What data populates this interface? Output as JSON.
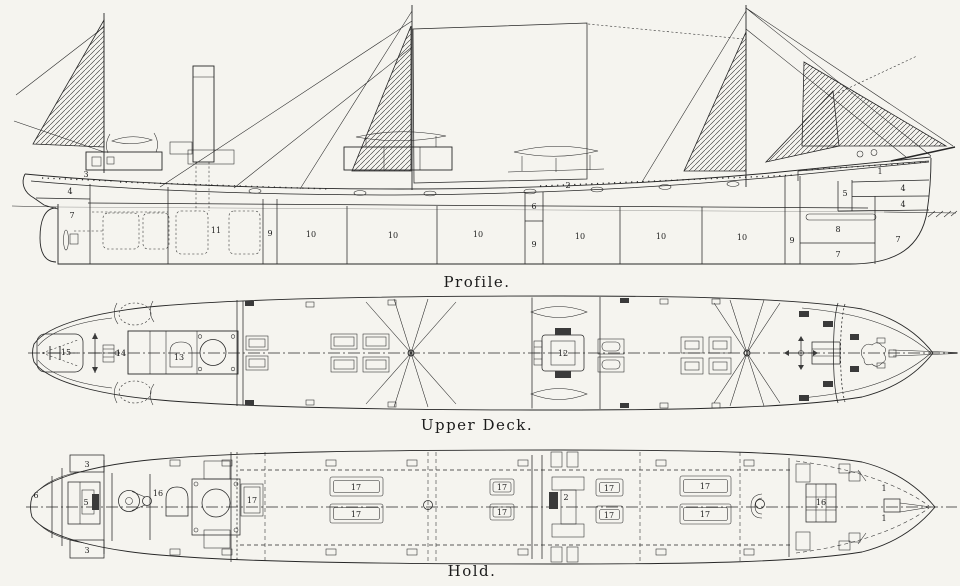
{
  "page": {
    "background": "#f5f4ef",
    "ink": "#272727"
  },
  "views": {
    "profile": {
      "caption": "Profile.",
      "labels": [
        {
          "t": "3",
          "x": 86,
          "y": 177
        },
        {
          "t": "4",
          "x": 70,
          "y": 194
        },
        {
          "t": "7",
          "x": 72,
          "y": 218
        },
        {
          "t": "11",
          "x": 216,
          "y": 233
        },
        {
          "t": "9",
          "x": 270,
          "y": 236
        },
        {
          "t": "10",
          "x": 311,
          "y": 237
        },
        {
          "t": "10",
          "x": 393,
          "y": 238
        },
        {
          "t": "10",
          "x": 478,
          "y": 237
        },
        {
          "t": "2",
          "x": 568,
          "y": 188
        },
        {
          "t": "6",
          "x": 534,
          "y": 209
        },
        {
          "t": "9",
          "x": 534,
          "y": 247
        },
        {
          "t": "10",
          "x": 580,
          "y": 239
        },
        {
          "t": "10",
          "x": 661,
          "y": 239
        },
        {
          "t": "10",
          "x": 742,
          "y": 240
        },
        {
          "t": "9",
          "x": 792,
          "y": 243
        },
        {
          "t": "8",
          "x": 838,
          "y": 232
        },
        {
          "t": "7",
          "x": 838,
          "y": 257
        },
        {
          "t": "1",
          "x": 880,
          "y": 174
        },
        {
          "t": "5",
          "x": 845,
          "y": 196
        },
        {
          "t": "4",
          "x": 903,
          "y": 191
        },
        {
          "t": "4",
          "x": 903,
          "y": 207
        },
        {
          "t": "7",
          "x": 898,
          "y": 242
        }
      ]
    },
    "upper_deck": {
      "caption": "Upper Deck.",
      "labels": [
        {
          "t": "15",
          "x": 66,
          "y": 355
        },
        {
          "t": "14",
          "x": 121,
          "y": 356
        },
        {
          "t": "13",
          "x": 179,
          "y": 360
        },
        {
          "t": "12",
          "x": 563,
          "y": 356
        }
      ]
    },
    "hold": {
      "caption": "Hold.",
      "labels": [
        {
          "t": "6",
          "x": 36,
          "y": 498
        },
        {
          "t": "3",
          "x": 87,
          "y": 467
        },
        {
          "t": "3",
          "x": 87,
          "y": 553
        },
        {
          "t": "5",
          "x": 86,
          "y": 505
        },
        {
          "t": "16",
          "x": 158,
          "y": 496
        },
        {
          "t": "17",
          "x": 252,
          "y": 503
        },
        {
          "t": "17",
          "x": 356,
          "y": 490
        },
        {
          "t": "17",
          "x": 356,
          "y": 517
        },
        {
          "t": "17",
          "x": 502,
          "y": 490
        },
        {
          "t": "17",
          "x": 502,
          "y": 515
        },
        {
          "t": "2",
          "x": 566,
          "y": 500
        },
        {
          "t": "17",
          "x": 609,
          "y": 491
        },
        {
          "t": "17",
          "x": 609,
          "y": 518
        },
        {
          "t": "17",
          "x": 705,
          "y": 489
        },
        {
          "t": "17",
          "x": 705,
          "y": 517
        },
        {
          "t": "16",
          "x": 821,
          "y": 505
        },
        {
          "t": "1",
          "x": 884,
          "y": 491
        },
        {
          "t": "1",
          "x": 884,
          "y": 521
        }
      ]
    }
  }
}
